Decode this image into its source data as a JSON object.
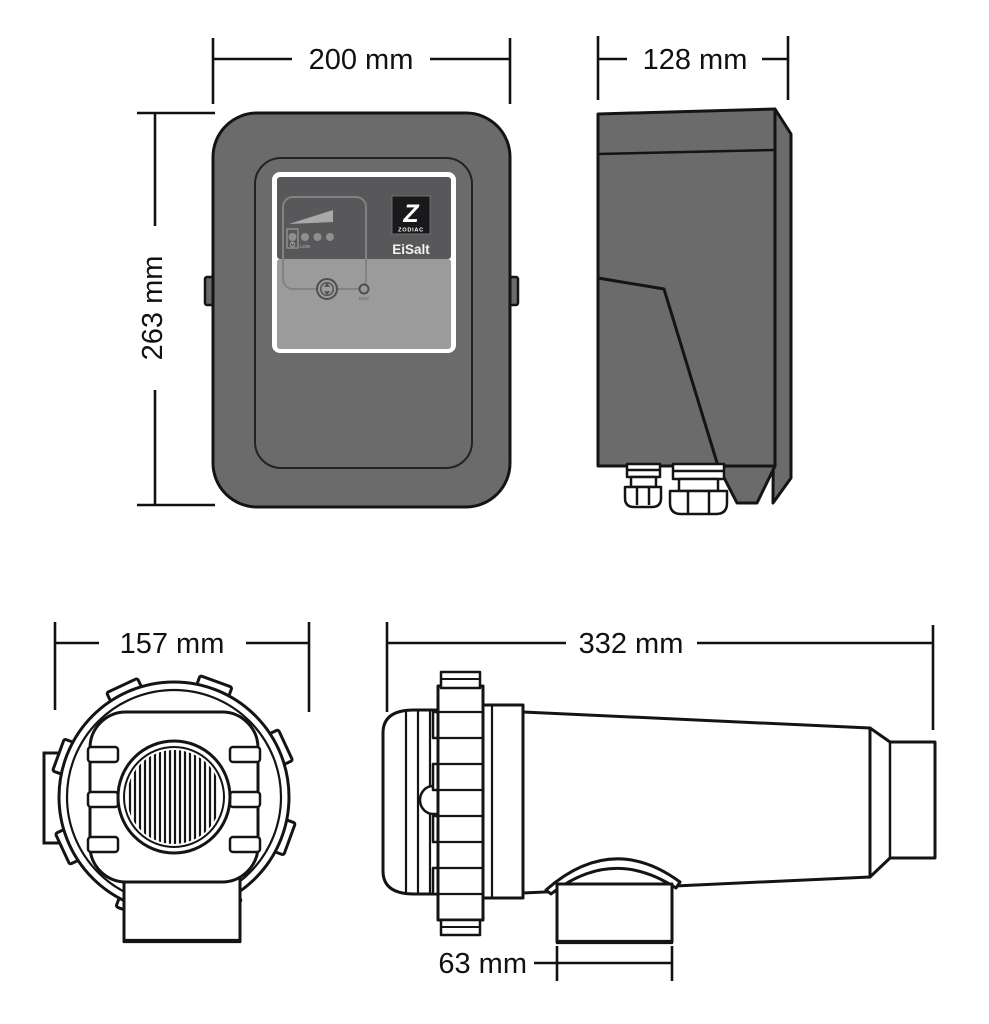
{
  "diagram": {
    "type": "technical-dimension-drawing",
    "product": "Zodiac EiSalt salt chlorinator - control box and electrolytic cell dimensional drawing",
    "views": {
      "control_box_front": "control box front view",
      "control_box_side": "control box side view",
      "cell_end": "cell end view",
      "cell_side": "cell side view"
    },
    "dimensions": {
      "box_width": {
        "label": "200 mm",
        "value": 200,
        "unit": "mm"
      },
      "box_depth": {
        "label": "128 mm",
        "value": 128,
        "unit": "mm"
      },
      "box_height": {
        "label": "263 mm",
        "value": 263,
        "unit": "mm"
      },
      "cell_diameter": {
        "label": "157 mm",
        "value": 157,
        "unit": "mm"
      },
      "cell_length": {
        "label": "332 mm",
        "value": 332,
        "unit": "mm"
      },
      "outlet_width": {
        "label": "63 mm",
        "value": 63,
        "unit": "mm"
      }
    },
    "branding": {
      "logo_letter": "Z",
      "brand": "ZODIAC",
      "model": "EiSalt"
    },
    "panel_labels": {
      "low": "LOW",
      "salt": "SALT"
    },
    "colors": {
      "enclosure_gray": "#6b6b6b",
      "panel_dark": "#58585a",
      "panel_light": "#9b9b9b",
      "line": "#141414",
      "background": "#ffffff"
    }
  }
}
